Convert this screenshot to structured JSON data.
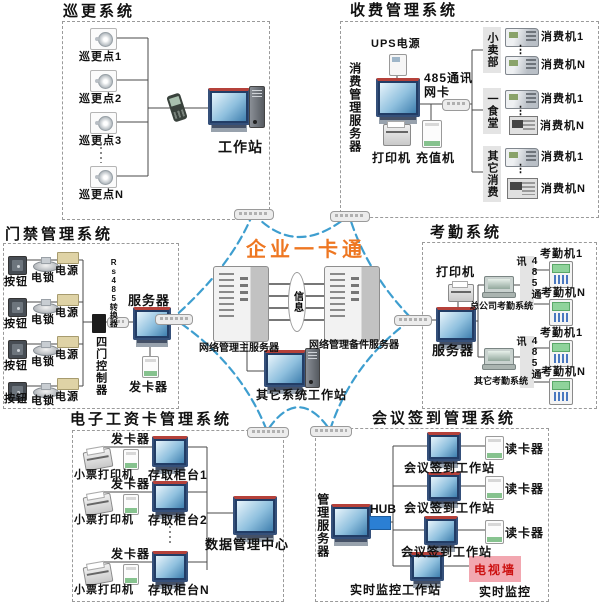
{
  "main": {
    "title": "企业一卡通",
    "info": "信息",
    "main_server": "网络管理主服务器",
    "backup_server": "网络管理备件服务器",
    "other_workstation": "其它系统工作站"
  },
  "misc": {
    "ellipsis": "⋮"
  },
  "patrol": {
    "title": "巡更系统",
    "points": [
      "巡更点1",
      "巡更点2",
      "巡更点3",
      "巡更点N"
    ],
    "workstation": "工作站"
  },
  "fee": {
    "title": "收费管理系统",
    "server": "消费管理服务器",
    "ups": "UPS电源",
    "netcard_line1": "485通讯",
    "netcard_line2": "网卡",
    "printer": "打印机",
    "recharge": "充值机",
    "groups": [
      {
        "name": "小卖部",
        "machine1": "消费机1",
        "machineN": "消费机N"
      },
      {
        "name": "一食堂",
        "machine1": "消费机1",
        "machineN": "消费机N"
      },
      {
        "name": "其它消费",
        "machine1": "消费机1",
        "machineN": "消费机N"
      }
    ]
  },
  "access": {
    "title": "门禁管理系统",
    "button": "按钮",
    "lock": "电锁",
    "power": "电源",
    "converter": "Rs485转换器",
    "controller": "四门控制器",
    "server": "服务器",
    "issuer": "发卡器"
  },
  "attendance": {
    "title": "考勤系统",
    "printer": "打印机",
    "server": "服务器",
    "groups": [
      {
        "pc": "总公司考勤系统",
        "comm": "485通讯",
        "machine1": "考勤机1",
        "machineN": "考勤机N"
      },
      {
        "pc": "其它考勤系统",
        "comm": "485通讯",
        "machine1": "考勤机1",
        "machineN": "考勤机N"
      }
    ]
  },
  "salary": {
    "title": "电子工资卡管理系统",
    "rows": [
      {
        "issuer": "发卡器",
        "printer": "小票打印机",
        "counter": "存取柜台1"
      },
      {
        "issuer": "发卡器",
        "printer": "小票打印机",
        "counter": "存取柜台2"
      },
      {
        "issuer": "发卡器",
        "printer": "小票打印机",
        "counter": "存取柜台N"
      }
    ],
    "datacenter": "数据管理中心"
  },
  "meeting": {
    "title": "会议签到管理系统",
    "server": "管理服务器",
    "hub": "HUB",
    "workstation": "会议签到工作站",
    "reader": "读卡器",
    "monitor_ws": "实时监控工作站",
    "tv_wall": "电视墙",
    "monitor": "实时监控"
  },
  "colors": {
    "accent_orange": "#ee7722",
    "star_blue": "#3e9ecf",
    "tv_pink": "#f2a7b0",
    "hub_blue": "#2b7fd4"
  }
}
